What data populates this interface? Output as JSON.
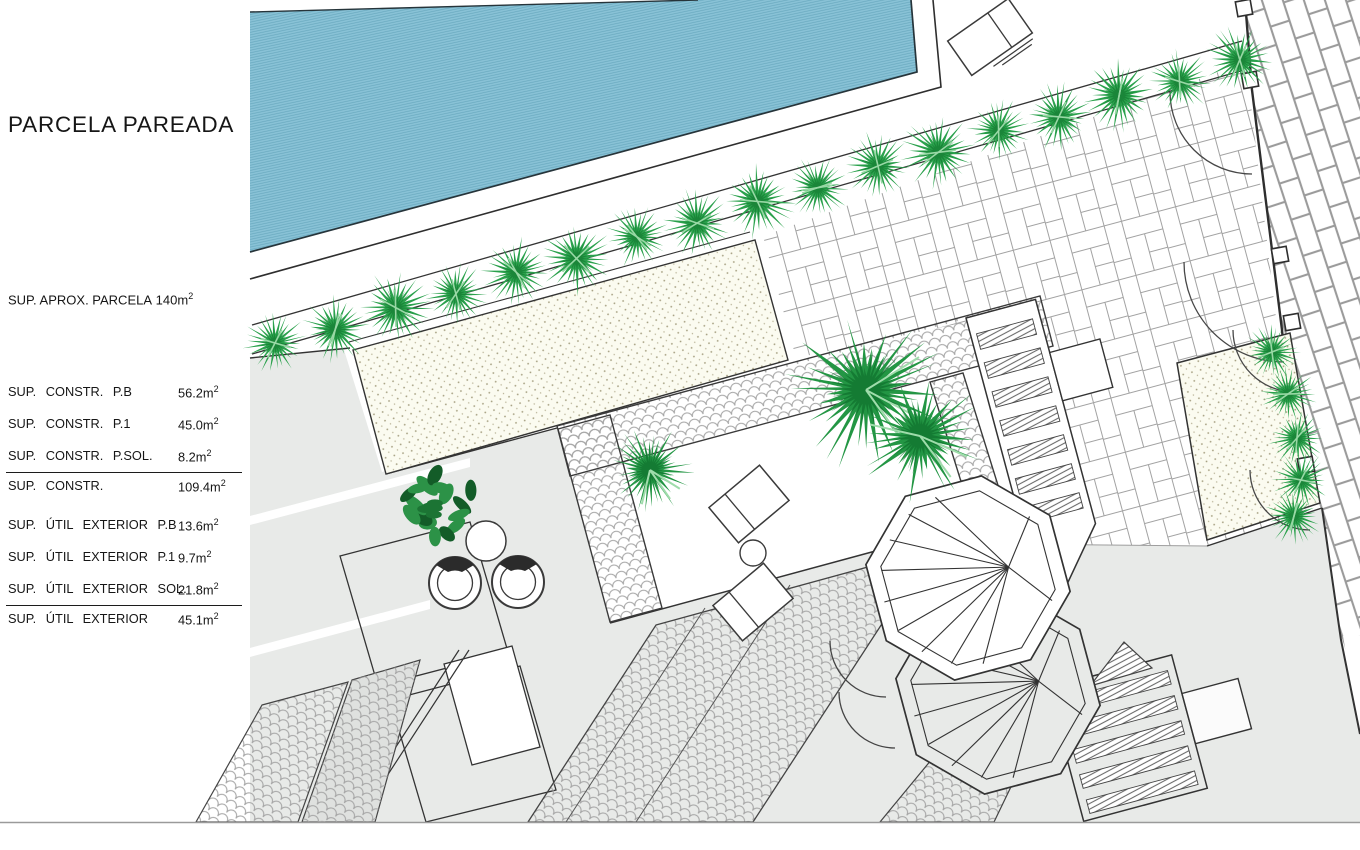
{
  "panel": {
    "title": "PARCELA PAREADA",
    "approx": {
      "label": "SUP. APROX. PARCELA",
      "value": "140"
    },
    "unit": "m",
    "unit_sup": "2",
    "constr": {
      "rows": [
        {
          "label": "SUP. CONSTR. P.B",
          "value": "56.2"
        },
        {
          "label": "SUP. CONSTR. P.1",
          "value": "45.0"
        },
        {
          "label": "SUP. CONSTR. P.SOL.",
          "value": "8.2"
        }
      ],
      "total": {
        "label": "SUP. CONSTR.",
        "value": "109.4"
      }
    },
    "util": {
      "rows": [
        {
          "label": "SUP. ÚTIL EXTERIOR P.B",
          "value": "13.6"
        },
        {
          "label": "SUP. ÚTIL EXTERIOR P.1",
          "value": "9.7"
        },
        {
          "label": "SUP. ÚTIL EXTERIOR SOL.",
          "value": "21.8"
        }
      ],
      "total": {
        "label": "SUP. ÚTIL EXTERIOR",
        "value": "45.1"
      }
    }
  },
  "plan": {
    "colors": {
      "pool": "#8ac3d7",
      "pool_line": "#69a9bf",
      "vegetation": "#2aa14c",
      "vegetation_dark": "#157d33",
      "paving_grey": "#e8eae8",
      "line_dark": "#333333",
      "pattern_line": "#a2a2a2",
      "stipple_bg": "#fbfbf0",
      "stipple_dot": "#a39d7e"
    },
    "features": [
      "pool",
      "hedge",
      "gravel-bed",
      "paver-patio",
      "sidewalk",
      "terrace",
      "spiral-stair-upper",
      "spiral-stair-lower",
      "exterior-stairs",
      "pergola",
      "sun-loungers",
      "round-chairs",
      "palm-trees",
      "tree",
      "driveway"
    ]
  }
}
